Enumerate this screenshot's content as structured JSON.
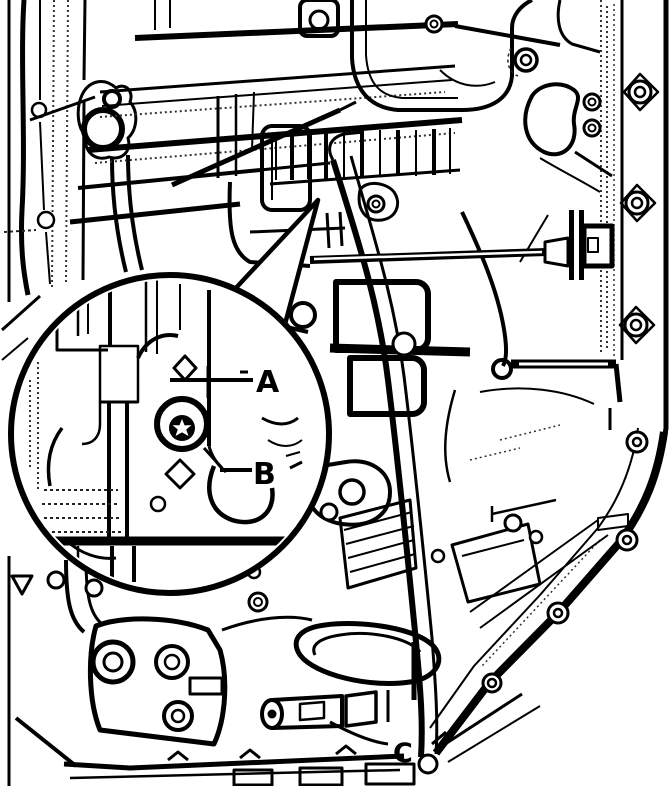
{
  "page": {
    "background_color": "#ffffff",
    "ink_color": "#000000"
  },
  "callout": {
    "label_a": "A",
    "label_b": "B"
  },
  "annotations": {
    "label_c": "C"
  }
}
